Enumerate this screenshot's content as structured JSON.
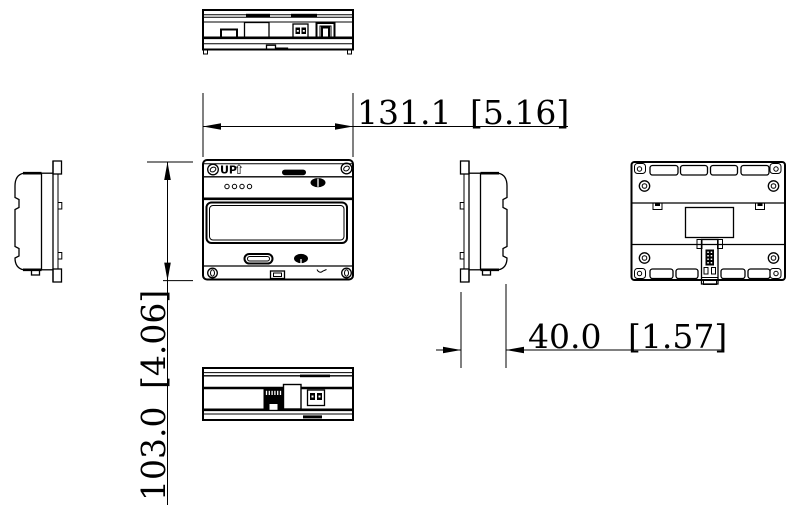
{
  "labels": {
    "up": "UP",
    "up_arrow": "⇧"
  },
  "dimensions": {
    "width": {
      "mm": "131.1",
      "inches": "[5.16]"
    },
    "height": {
      "mm": "103.0",
      "inches": "[4.06]"
    },
    "depth": {
      "mm": "40.0",
      "inches": "[1.57]"
    }
  },
  "colors": {
    "line": "#000000",
    "background": "#ffffff"
  }
}
